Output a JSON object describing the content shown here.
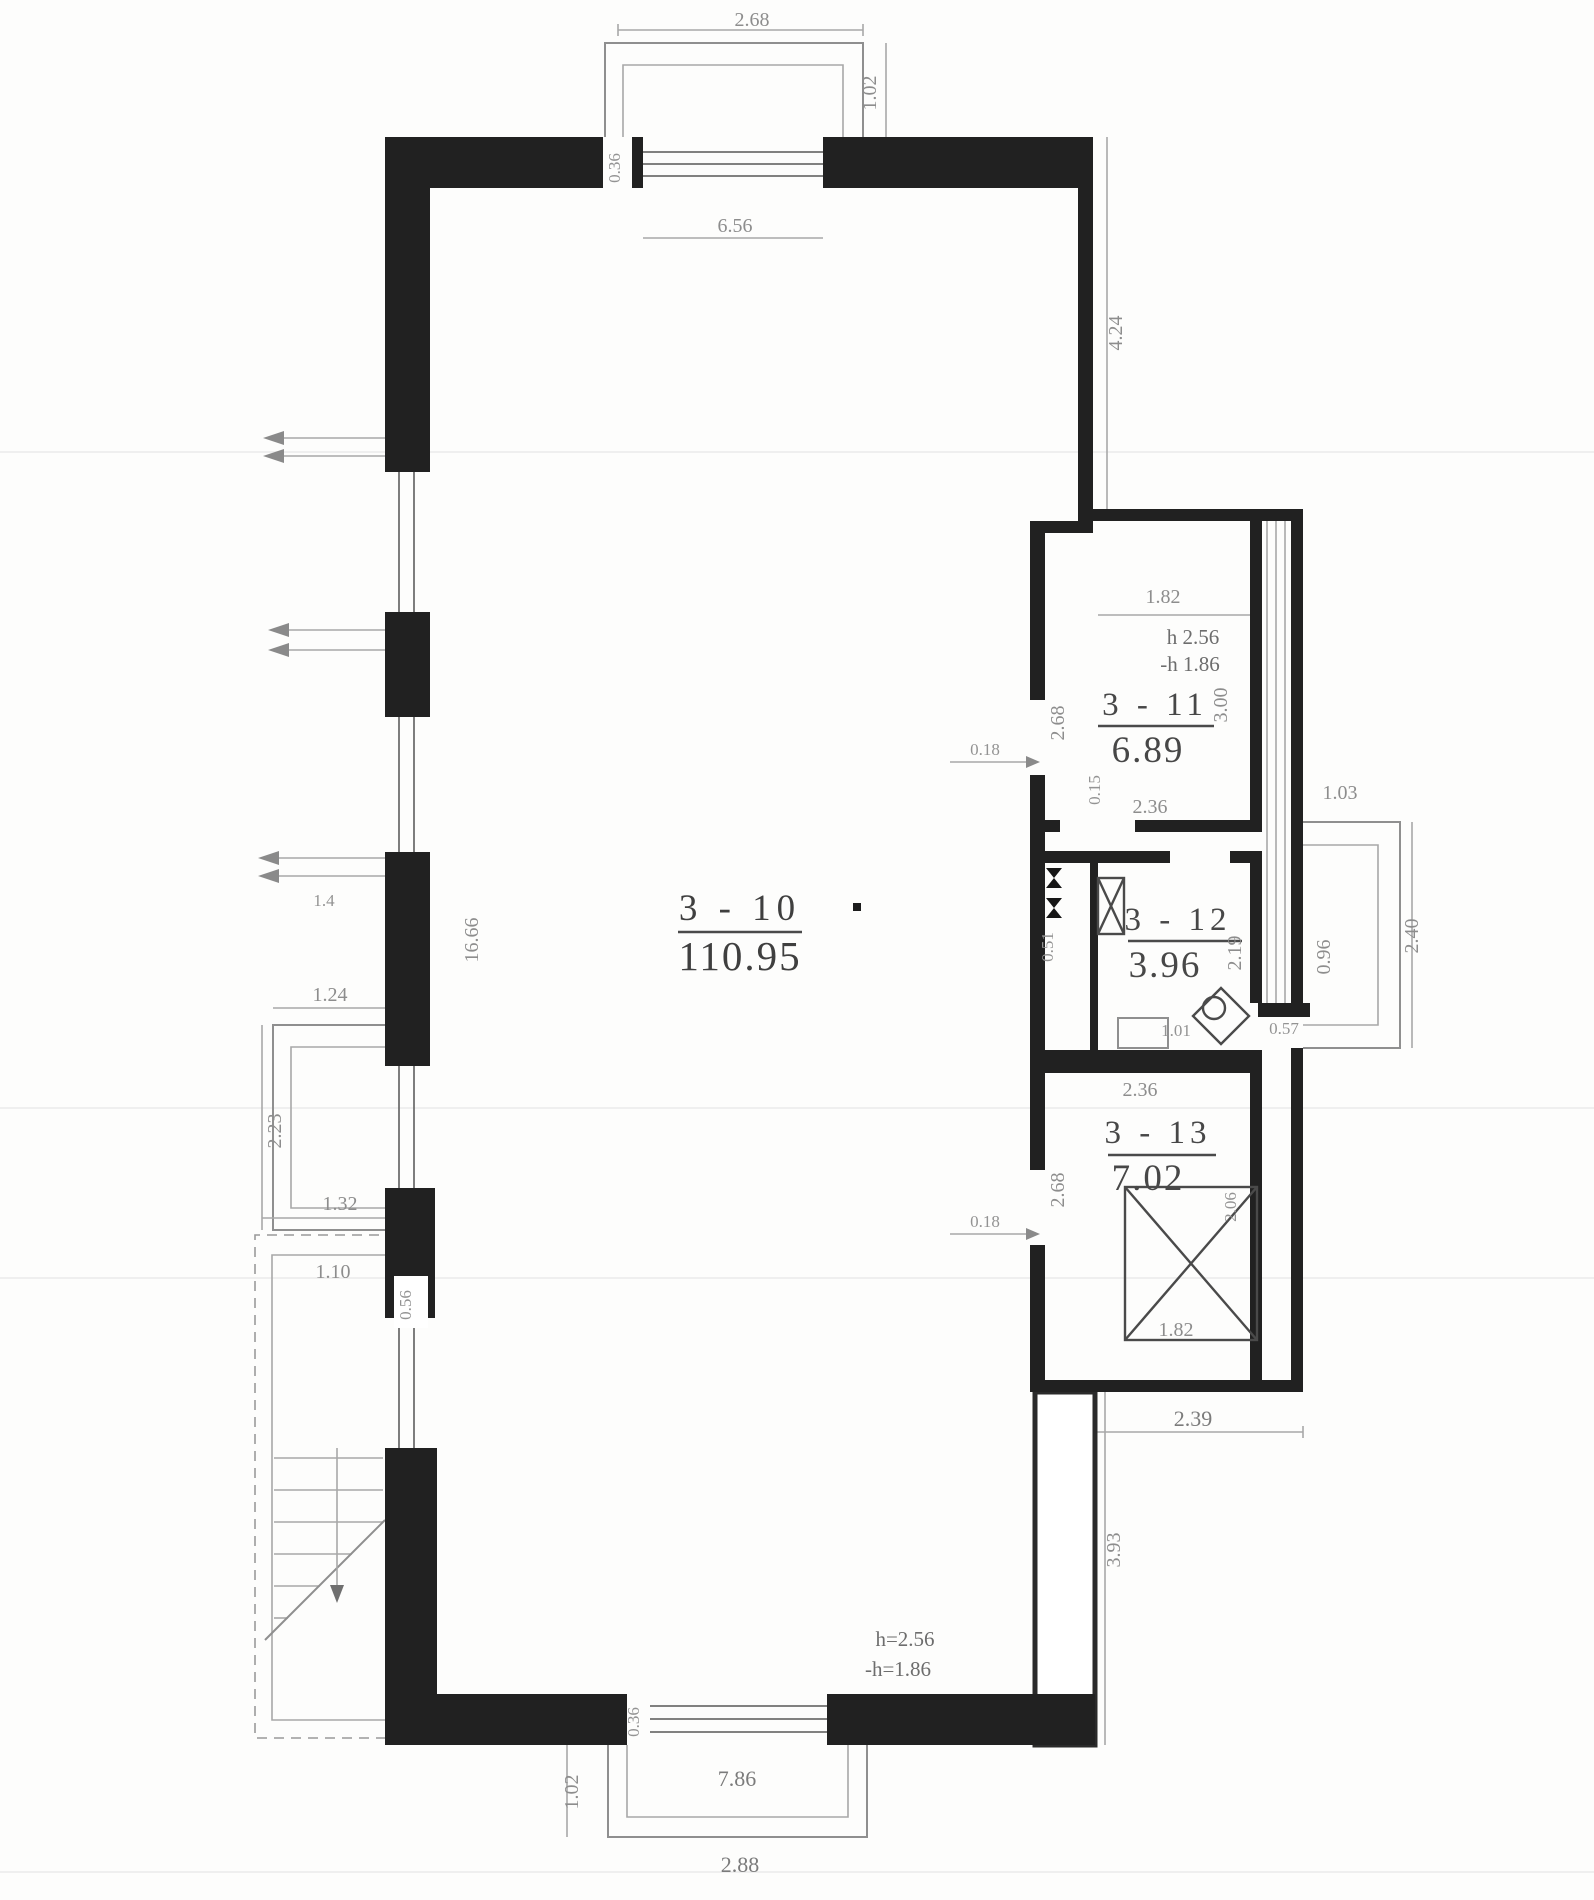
{
  "doc": {
    "type": "architectural floor plan, scanned technical passport sheet"
  },
  "rooms": {
    "main": {
      "id": "3 - 10",
      "area": "110.95"
    },
    "r11": {
      "id": "3 - 11",
      "area": "6.89",
      "height": "h 2.56",
      "height_minus": "-h 1.86"
    },
    "r12": {
      "id": "3 - 12",
      "area": "3.96"
    },
    "r13": {
      "id": "3 - 13",
      "area": "7.02"
    }
  },
  "notes": {
    "bottom_height": "h=2.56",
    "bottom_height_minus": "-h=1.86"
  },
  "dims": {
    "top_width": "2.68",
    "top_balcony_depth": "1.02",
    "top_inner_width": "6.56",
    "top_pier": "0.36",
    "right_upper_height": "4.24",
    "left_length": "16.66",
    "left_small": "1.4",
    "left_balcony_width": "1.24",
    "left_balcony_height": "2.23",
    "left_mid": "1.32",
    "left_terrace": "1.10",
    "left_pier": "0.56",
    "r11_top_width": "1.82",
    "r11_height": "3.00",
    "r11_bottom_width": "2.36",
    "r11_door": "0.15",
    "door_gap_upper": "0.18",
    "party_upper": "2.68",
    "r12_depth": "2.19",
    "sink": "1.01",
    "shaft": "0.51",
    "wc_wall": "0.57",
    "rbalc_width": "1.03",
    "rbalc_inner": "0.96",
    "rbalc_depth": "2.40",
    "r13_top_width": "2.36",
    "party_lower": "2.68",
    "door_gap_lower": "0.18",
    "x_width": "1.82",
    "x_height": "2.06",
    "annex_bottom": "2.39",
    "right_lower_height": "3.93",
    "bottom_pier": "0.36",
    "bottom_inner_width": "7.86",
    "bottom_balcony_depth": "1.02",
    "bottom_width": "2.88"
  }
}
